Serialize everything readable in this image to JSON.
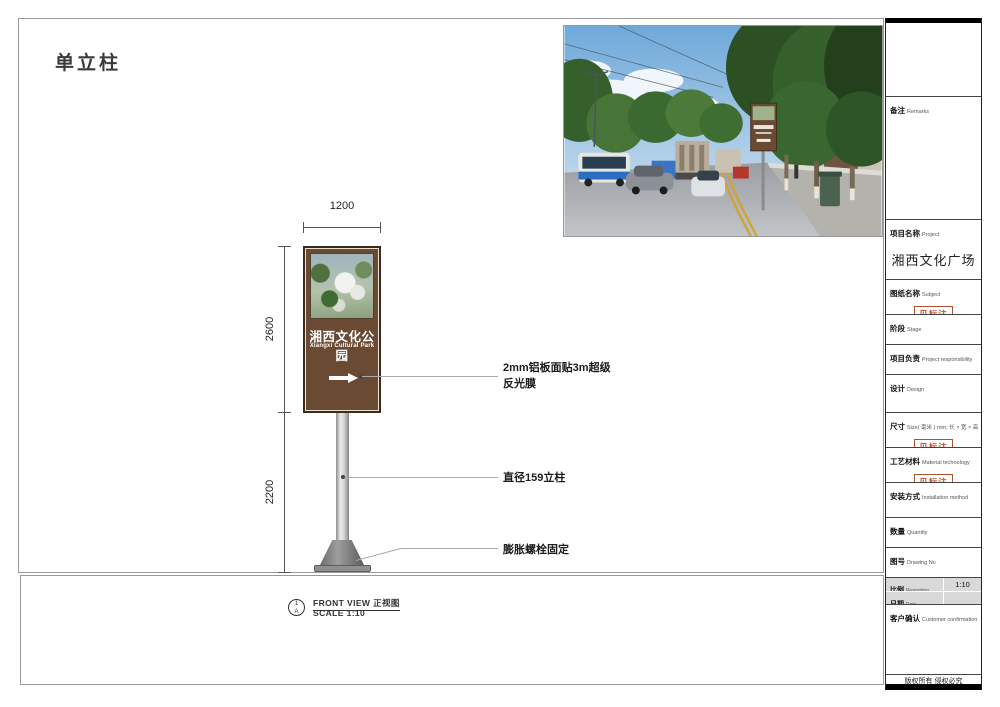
{
  "page": {
    "title": "单立柱"
  },
  "drawing": {
    "dim_top": "1200",
    "dim_upper": "2600",
    "dim_lower": "2200",
    "sign_title": "湘西文化公园",
    "sign_subtitle": "Xiangxi Cultural Park",
    "ann_panel_line1": "2mm铝板面贴3m超级",
    "ann_panel_line2": "反光膜",
    "ann_pole": "直径159立柱",
    "ann_base": "膨胀螺栓固定",
    "marker_top": "1",
    "marker_bottom": "A",
    "view_label": "FRONT VIEW 正视图",
    "scale_label": "SCALE 1:10"
  },
  "titleblock": {
    "remarks": {
      "zh": "备注",
      "en": "Remarks"
    },
    "project": {
      "zh": "项目名称",
      "en": "Project",
      "value": "湘西文化广场"
    },
    "subject": {
      "zh": "图纸名称",
      "en": "Subject",
      "stamp": "见标注"
    },
    "stage": {
      "zh": "阶段",
      "en": "Stage"
    },
    "responsibility": {
      "zh": "项目负责",
      "en": "Project responsibility"
    },
    "design": {
      "zh": "设计",
      "en": "Design"
    },
    "size": {
      "zh": "尺寸",
      "en": "Size( 毫米 ) mm; 长 × 宽 × 高",
      "stamp": "见标注"
    },
    "material": {
      "zh": "工艺材料",
      "en": "Material technology",
      "stamp": "见标注"
    },
    "installation": {
      "zh": "安装方式",
      "en": "Installation method"
    },
    "quantity": {
      "zh": "数量",
      "en": "Quantity"
    },
    "drawing_no": {
      "zh": "图号",
      "en": "Drawing No"
    },
    "proportion": {
      "zh": "比例",
      "en": "Proportion",
      "value": "1:10"
    },
    "date": {
      "zh": "日期",
      "en": "Date"
    },
    "customer": {
      "zh": "客户确认",
      "en": "Customer confirmation"
    },
    "copyright": "版权所有  侵权必究"
  },
  "colors": {
    "sign_brown": "#6b4a33",
    "stamp_red": "#b5502d"
  }
}
